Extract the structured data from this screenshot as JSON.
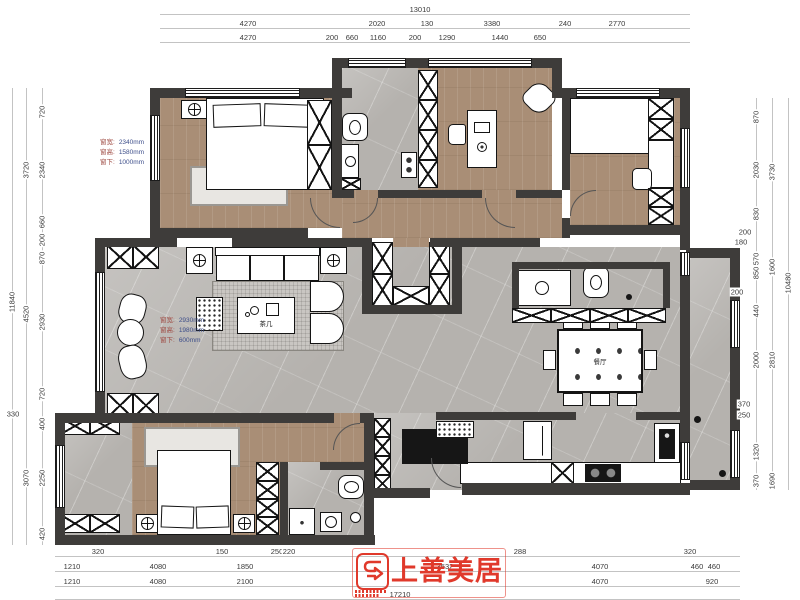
{
  "logo": {
    "name": "上善美居"
  },
  "room_labels": [
    {
      "t": "茶几",
      "x": 266,
      "y": 323
    },
    {
      "t": "餐厅",
      "x": 600,
      "y": 361
    }
  ],
  "annotations": [
    {
      "x": 100,
      "y": 138,
      "lines": [
        [
          "窗宽:",
          "2340mm"
        ],
        [
          "窗高:",
          "1580mm"
        ],
        [
          "窗下:",
          "1000mm"
        ]
      ]
    },
    {
      "x": 160,
      "y": 316,
      "lines": [
        [
          "窗宽:",
          "2930mm"
        ],
        [
          "窗高:",
          "1980mm"
        ],
        [
          "窗下:",
          "600mm"
        ]
      ]
    }
  ],
  "dimensions": {
    "rows": [
      {
        "name": "top-total",
        "orient": "h",
        "y": 14,
        "labels": [
          {
            "t": "13010",
            "x": 420
          }
        ]
      },
      {
        "name": "top-row2",
        "orient": "h",
        "y": 28,
        "labels": [
          {
            "t": "4270",
            "x": 248
          },
          {
            "t": "2020",
            "x": 377
          },
          {
            "t": "130",
            "x": 427
          },
          {
            "t": "3380",
            "x": 492
          },
          {
            "t": "240",
            "x": 565
          },
          {
            "t": "2770",
            "x": 617
          }
        ]
      },
      {
        "name": "top-row3",
        "orient": "h",
        "y": 42,
        "labels": [
          {
            "t": "4270",
            "x": 248
          },
          {
            "t": "200",
            "x": 332
          },
          {
            "t": "660",
            "x": 352
          },
          {
            "t": "1160",
            "x": 378
          },
          {
            "t": "200",
            "x": 415
          },
          {
            "t": "1290",
            "x": 447
          },
          {
            "t": "1440",
            "x": 500
          },
          {
            "t": "650",
            "x": 540
          }
        ]
      },
      {
        "name": "bottom-row1",
        "orient": "h",
        "y": 556,
        "labels": [
          {
            "t": "320",
            "x": 98
          },
          {
            "t": "150",
            "x": 222
          },
          {
            "t": "250",
            "x": 277
          },
          {
            "t": "220",
            "x": 289
          },
          {
            "t": "288",
            "x": 520
          },
          {
            "t": "320",
            "x": 690
          }
        ]
      },
      {
        "name": "bottom-row2",
        "orient": "h",
        "y": 571,
        "labels": [
          {
            "t": "1210",
            "x": 72
          },
          {
            "t": "4080",
            "x": 158
          },
          {
            "t": "1850",
            "x": 245
          },
          {
            "t": "3532",
            "x": 445
          },
          {
            "t": "4070",
            "x": 600
          },
          {
            "t": "460",
            "x": 697
          },
          {
            "t": "460",
            "x": 714
          }
        ]
      },
      {
        "name": "bottom-row3",
        "orient": "h",
        "y": 586,
        "labels": [
          {
            "t": "1210",
            "x": 72
          },
          {
            "t": "4080",
            "x": 158
          },
          {
            "t": "2100",
            "x": 245
          },
          {
            "t": "4070",
            "x": 600
          },
          {
            "t": "920",
            "x": 712
          }
        ]
      },
      {
        "name": "bottom-total",
        "orient": "h",
        "y": 599,
        "labels": [
          {
            "t": "17210",
            "x": 400
          }
        ]
      },
      {
        "name": "left-inner",
        "orient": "v",
        "x": 42,
        "labels": [
          {
            "t": "720",
            "y": 112
          },
          {
            "t": "2340",
            "y": 170
          },
          {
            "t": "660",
            "y": 222
          },
          {
            "t": "200",
            "y": 240
          },
          {
            "t": "870",
            "y": 258
          },
          {
            "t": "2930",
            "y": 322
          },
          {
            "t": "720",
            "y": 394
          },
          {
            "t": "400",
            "y": 424
          },
          {
            "t": "2250",
            "y": 478
          },
          {
            "t": "420",
            "y": 534
          }
        ]
      },
      {
        "name": "left-mid",
        "orient": "v",
        "x": 26,
        "labels": [
          {
            "t": "3720",
            "y": 170
          },
          {
            "t": "4520",
            "y": 314
          },
          {
            "t": "3070",
            "y": 478
          }
        ]
      },
      {
        "name": "left-outer",
        "orient": "v",
        "x": 12,
        "labels": [
          {
            "t": "11840",
            "y": 302
          }
        ]
      },
      {
        "name": "right-inner",
        "orient": "v",
        "x": 756,
        "labels": [
          {
            "t": "870",
            "y": 117
          },
          {
            "t": "2030",
            "y": 170
          },
          {
            "t": "830",
            "y": 214
          },
          {
            "t": "570",
            "y": 259
          },
          {
            "t": "850",
            "y": 273
          },
          {
            "t": "440",
            "y": 311
          },
          {
            "t": "2000",
            "y": 360
          },
          {
            "t": "1320",
            "y": 452
          },
          {
            "t": "370",
            "y": 481
          }
        ]
      },
      {
        "name": "right-mid",
        "orient": "v",
        "x": 772,
        "labels": [
          {
            "t": "3730",
            "y": 172
          },
          {
            "t": "1600",
            "y": 267
          },
          {
            "t": "2810",
            "y": 360
          },
          {
            "t": "1690",
            "y": 481
          }
        ]
      },
      {
        "name": "right-outer",
        "orient": "v",
        "x": 788,
        "labels": [
          {
            "t": "10480",
            "y": 283
          }
        ]
      }
    ],
    "free": [
      {
        "t": "330",
        "x": 13,
        "y": 414
      },
      {
        "t": "200",
        "x": 745,
        "y": 232
      },
      {
        "t": "180",
        "x": 741,
        "y": 242
      },
      {
        "t": "200",
        "x": 737,
        "y": 292
      },
      {
        "t": "370",
        "x": 744,
        "y": 404
      },
      {
        "t": "250",
        "x": 744,
        "y": 415
      }
    ]
  }
}
